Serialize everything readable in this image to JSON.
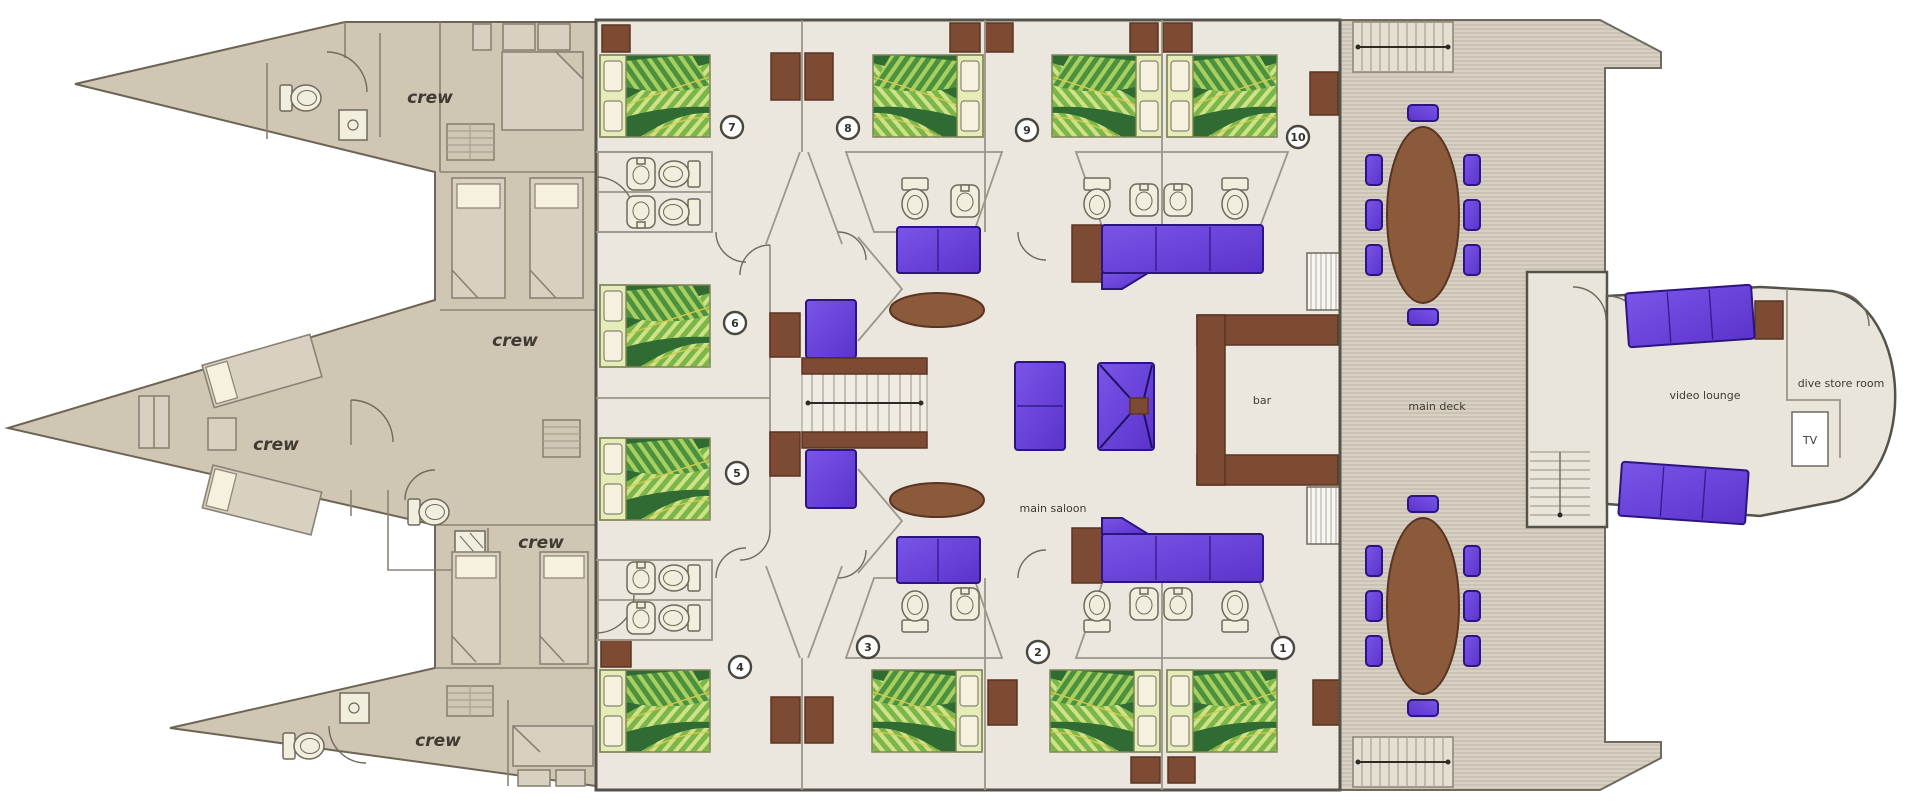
{
  "labels": {
    "crew": "crew",
    "main_saloon": "main saloon",
    "bar": "bar",
    "main_deck": "main deck",
    "video_lounge": "video lounge",
    "dive_store_room": "dive store room",
    "tv": "TV"
  },
  "cabin_numbers": [
    "1",
    "2",
    "3",
    "4",
    "5",
    "6",
    "7",
    "8",
    "9",
    "10"
  ],
  "colors": {
    "hull": "#cfc6b4",
    "hull_room": "#d8d0c0",
    "hull_line": "#8a8273",
    "floor": "#ebe7de",
    "wall": "#9b9687",
    "wall_dark": "#55524a",
    "deck": "#d8d1c3",
    "deck_line": "#bdb4a4",
    "brown": "#7d4a33",
    "brown_dark": "#5a3423",
    "table_brown": "#8a5a3b",
    "purple": "#5b33cc",
    "purple_hi": "#7a55e8",
    "purple_dark": "#2c1580",
    "duvet_dark": "#2f6b33",
    "duvet_mid": "#7ab648",
    "duvet_light": "#cfe28a",
    "duvet_vein": "#d9c94f",
    "pillow_panel": "#e6ecb8",
    "pillow": "#f6f1de",
    "fixture": "#f2eedd",
    "fixline": "#6e6a5c",
    "text": "#3f3b33"
  }
}
